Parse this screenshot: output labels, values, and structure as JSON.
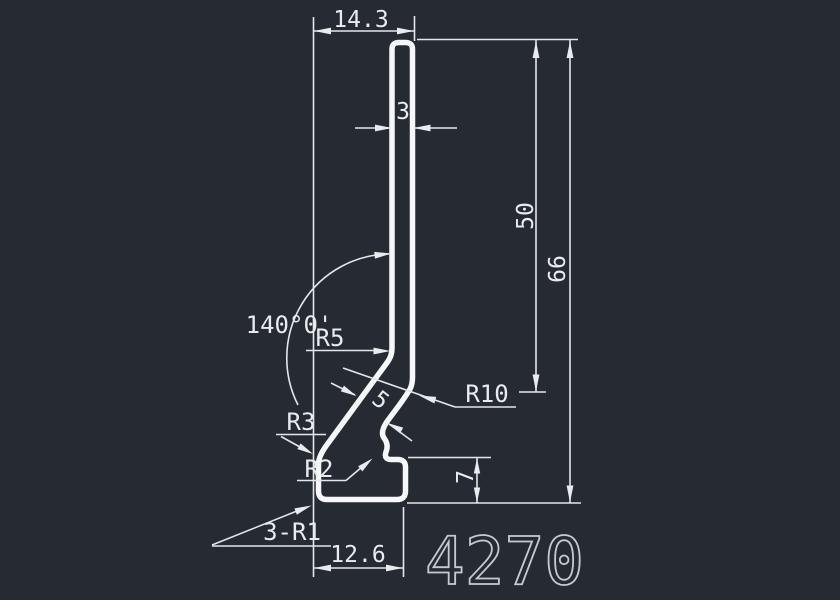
{
  "colors": {
    "background": "#262A33",
    "profile_line": "#F5F7F9",
    "dimension": "#E8ECEF",
    "part_number": "#C4CAD2"
  },
  "drawing": {
    "part_number": "4270",
    "dims": {
      "top_width": "14.3",
      "wall_thickness": "3",
      "upper_height": "50",
      "total_height": "66",
      "bend_angle": "140°0'",
      "bend_radius": "R5",
      "inner_bend_radius": "R10",
      "slant_thickness": "5",
      "lower_outer_radius": "R3",
      "lower_inner_radius": "R2",
      "foot_height": "7",
      "fillet_note": "3-R1",
      "foot_width": "12.6"
    }
  }
}
